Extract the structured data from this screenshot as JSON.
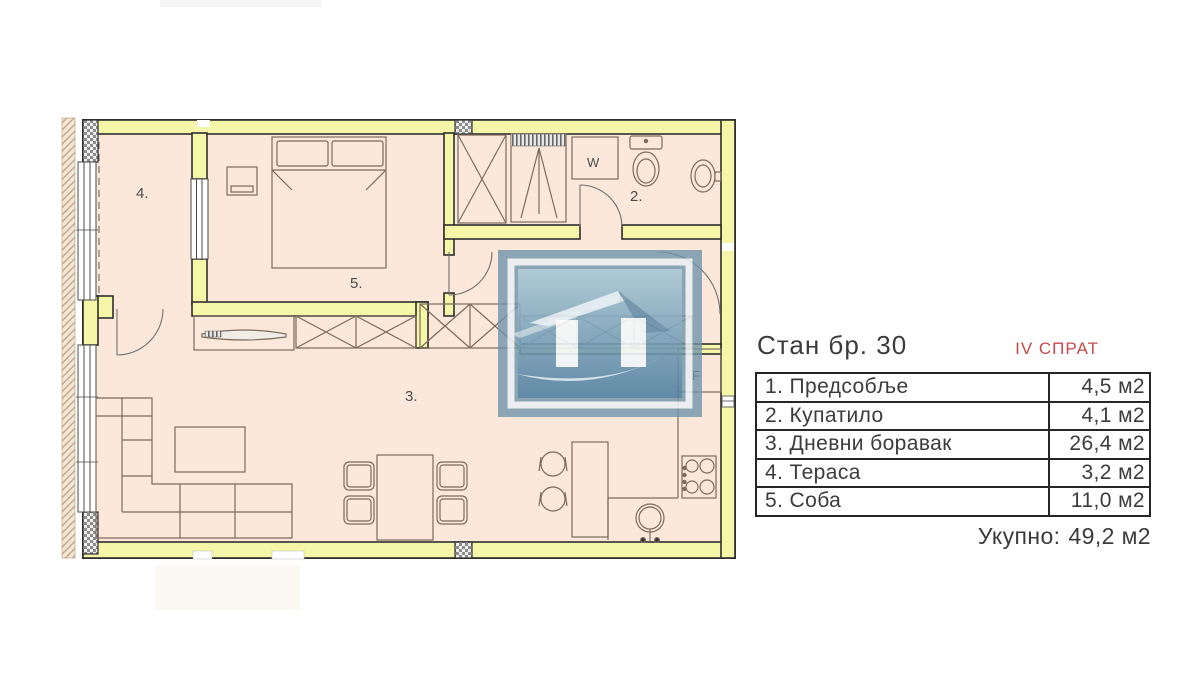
{
  "plan": {
    "labels": {
      "hallway": "1.",
      "bathroom": "2.",
      "living": "3.",
      "terrace": "4.",
      "bedroom": "5.",
      "washer": "W",
      "fridge": "F"
    },
    "colors": {
      "wall": "#f6f6a9",
      "floor": "#fbe8da",
      "outline": "#2e2e2e",
      "furniture_line": "#7b6b5e",
      "watermark_blue": "#6e93aa"
    }
  },
  "panel": {
    "title": "Стан бр. 30",
    "floor": "IV СПРАТ",
    "floor_color": "#c64a4c",
    "rows": [
      {
        "name": "1. Предсобље",
        "area": "4,5 м2"
      },
      {
        "name": "2. Купатило",
        "area": "4,1 м2"
      },
      {
        "name": "3. Дневни боравак",
        "area": "26,4 м2"
      },
      {
        "name": "4. Тераса",
        "area": "3,2 м2"
      },
      {
        "name": "5. Соба",
        "area": "11,0 м2"
      }
    ],
    "total_label": "Укупно:",
    "total_value": "49,2 м2"
  }
}
